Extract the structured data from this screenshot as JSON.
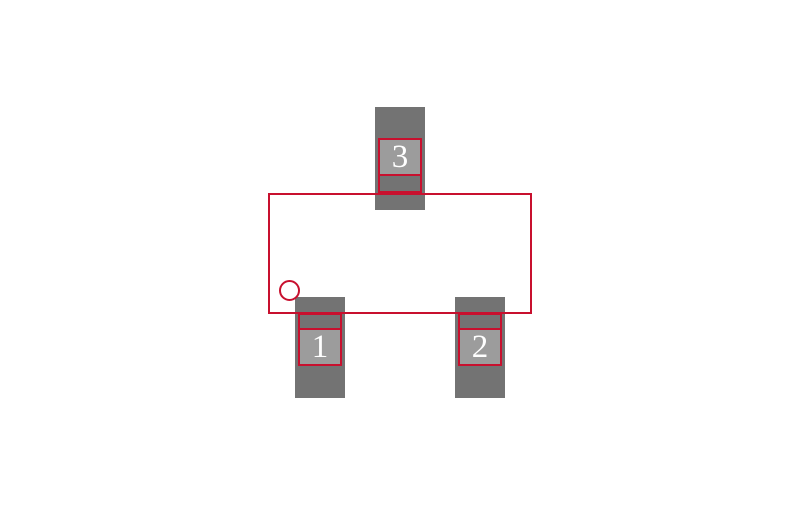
{
  "footprint": {
    "pads": [
      {
        "label": "1"
      },
      {
        "label": "2"
      },
      {
        "label": "3"
      }
    ]
  },
  "colors": {
    "background": "#FFFFFF",
    "outline": "#C8102E",
    "pad_copper": "#737373",
    "pad_contact": "#9C9C9C",
    "pad_number_text": "#FFFFFF"
  }
}
